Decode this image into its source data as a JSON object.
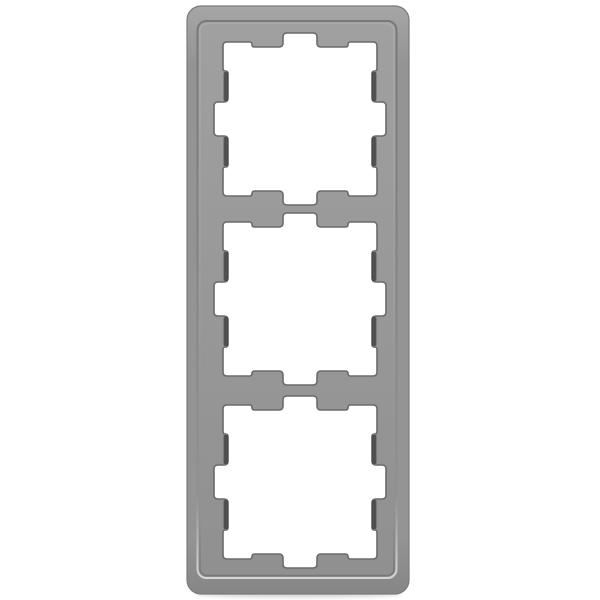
{
  "image": {
    "description": "Product photo of a 3-gang (triple) wall switch cover frame in stainless-steel gray, portrait orientation, centered on a plain white background",
    "background_color": "#ffffff",
    "frame": {
      "gang_count": 3,
      "openings": [
        {
          "label": "module-cutout-1"
        },
        {
          "label": "module-cutout-2"
        },
        {
          "label": "module-cutout-3"
        }
      ],
      "colors": {
        "rim_top": "#a6a6a6",
        "rim_base": "#949494",
        "rim_bottom": "#868686",
        "outer_edge": "#7b7b7b",
        "face_top": "#a0a0a0",
        "face_bottom": "#909090",
        "groove_dark": "#787878",
        "ridge_light": "#aaaaaa",
        "ridge_bright_bottom": "#d6d6d6",
        "opening_outline": "#6b6b6b",
        "tab_shadow_slit": "#414141",
        "opening_fill": "#ffffff",
        "contact_shadow": "#000000"
      }
    }
  }
}
